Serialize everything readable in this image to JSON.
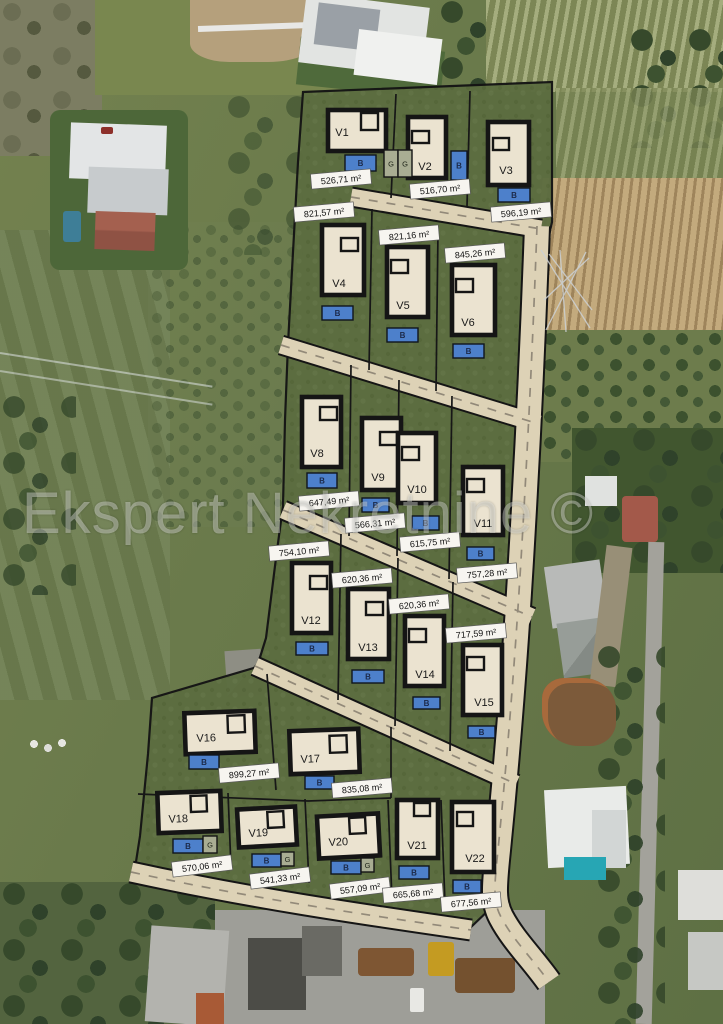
{
  "watermark": "Ekspert Nekretnine ©",
  "plan": {
    "unit": "m²",
    "badge_b_label": "B",
    "badge_g_label": "G",
    "colors": {
      "road": "#ddd2b6",
      "plan_grass": "#5c6d40",
      "house_fill": "#ebe3d0",
      "outline": "#151515",
      "badge_blue": "#4d80cb",
      "garage_fill": "#a9ad93",
      "area_label_bg": "#f7f5f0"
    },
    "extra_garages": [
      [
        384,
        150,
        14,
        27
      ],
      [
        398,
        150,
        14,
        27
      ]
    ],
    "villas": [
      {
        "id": "V1",
        "area": "526,71 m²",
        "house": [
          328,
          110,
          58,
          41
        ],
        "notch": [
          361,
          113,
          17,
          17
        ],
        "label": [
          342,
          132
        ],
        "badge": [
          345,
          155,
          31,
          16
        ],
        "area_label": [
          341,
          179,
          -5
        ]
      },
      {
        "id": "V2",
        "area": "516,70 m²",
        "house": [
          408,
          117,
          38,
          61
        ],
        "notch": [
          412,
          131,
          17,
          12
        ],
        "label": [
          425,
          166
        ],
        "badge": [
          451,
          151,
          16,
          29
        ],
        "area_label": [
          440,
          189,
          -5
        ]
      },
      {
        "id": "V3",
        "area": "596,19 m²",
        "house": [
          488,
          122,
          41,
          63
        ],
        "notch": [
          493,
          138,
          16,
          12
        ],
        "label": [
          506,
          170
        ],
        "badge": [
          498,
          188,
          32,
          14
        ],
        "area_label": [
          521,
          212,
          -5
        ]
      },
      {
        "id": "V4",
        "area": "821,57 m²",
        "house": [
          322,
          225,
          42,
          70
        ],
        "notch": [
          341,
          238,
          17,
          13
        ],
        "label": [
          339,
          283
        ],
        "badge": [
          322,
          306,
          31,
          14
        ],
        "area_label": [
          324,
          212,
          -5
        ]
      },
      {
        "id": "V5",
        "area": "821,16 m²",
        "house": [
          387,
          247,
          41,
          70
        ],
        "notch": [
          391,
          260,
          17,
          13
        ],
        "label": [
          403,
          305
        ],
        "badge": [
          387,
          328,
          31,
          14
        ],
        "area_label": [
          409,
          235,
          -5
        ]
      },
      {
        "id": "V6",
        "area": "845,26 m²",
        "house": [
          452,
          265,
          43,
          70
        ],
        "notch": [
          456,
          279,
          17,
          13
        ],
        "label": [
          468,
          322
        ],
        "badge": [
          453,
          344,
          31,
          14
        ],
        "area_label": [
          475,
          253,
          -5
        ]
      },
      {
        "id": "V8",
        "area": "647,49 m²",
        "house": [
          302,
          397,
          39,
          70
        ],
        "notch": [
          320,
          407,
          17,
          13
        ],
        "label": [
          317,
          453
        ],
        "badge": [
          307,
          473,
          30,
          15
        ],
        "area_label": [
          329,
          501,
          -5
        ]
      },
      {
        "id": "V9",
        "area": "566,31 m²",
        "house": [
          362,
          418,
          39,
          72
        ],
        "notch": [
          380,
          432,
          17,
          13
        ],
        "label": [
          378,
          477
        ],
        "badge": [
          362,
          498,
          27,
          14
        ],
        "area_label": [
          375,
          523,
          -5
        ]
      },
      {
        "id": "V10",
        "area": "615,75 m²",
        "house": [
          398,
          433,
          38,
          70
        ],
        "notch": [
          402,
          447,
          17,
          13
        ],
        "label": [
          417,
          489
        ],
        "badge": [
          412,
          516,
          27,
          14
        ],
        "area_label": [
          430,
          542,
          -5
        ]
      },
      {
        "id": "V11",
        "area": "757,28 m²",
        "house": [
          463,
          467,
          40,
          68
        ],
        "notch": [
          467,
          479,
          17,
          13
        ],
        "label": [
          483,
          523
        ],
        "badge": [
          467,
          547,
          27,
          13
        ],
        "area_label": [
          487,
          573,
          -5
        ]
      },
      {
        "id": "V12",
        "area": "754,10 m²",
        "house": [
          292,
          563,
          39,
          70
        ],
        "notch": [
          310,
          576,
          17,
          13
        ],
        "label": [
          311,
          620
        ],
        "badge": [
          296,
          642,
          32,
          13
        ],
        "area_label": [
          299,
          551,
          -5
        ]
      },
      {
        "id": "V13",
        "area": "620,36 m²",
        "house": [
          348,
          589,
          41,
          70
        ],
        "notch": [
          366,
          602,
          17,
          13
        ],
        "label": [
          368,
          647
        ],
        "badge": [
          352,
          670,
          32,
          13
        ],
        "area_label": [
          362,
          578,
          -5
        ]
      },
      {
        "id": "V14",
        "area": "620,36 m²",
        "house": [
          405,
          616,
          39,
          70
        ],
        "notch": [
          409,
          629,
          17,
          13
        ],
        "label": [
          425,
          674
        ],
        "badge": [
          413,
          697,
          27,
          12
        ],
        "area_label": [
          419,
          604,
          -5
        ]
      },
      {
        "id": "V15",
        "area": "717,59 m²",
        "house": [
          463,
          645,
          39,
          70
        ],
        "notch": [
          467,
          657,
          17,
          13
        ],
        "label": [
          484,
          702
        ],
        "badge": [
          468,
          726,
          27,
          12
        ],
        "area_label": [
          476,
          633,
          -5
        ]
      },
      {
        "id": "V16",
        "area": "899,27 m²",
        "house": [
          185,
          712,
          70,
          41,
          -2
        ],
        "notch": [
          228,
          716,
          17,
          17
        ],
        "label": [
          206,
          737
        ],
        "badge": [
          189,
          755,
          30,
          14
        ],
        "area_label": [
          249,
          773,
          -5
        ]
      },
      {
        "id": "V17",
        "area": "835,08 m²",
        "house": [
          290,
          730,
          69,
          43,
          -2
        ],
        "notch": [
          330,
          736,
          17,
          17
        ],
        "label": [
          310,
          758
        ],
        "badge": [
          305,
          776,
          29,
          13
        ],
        "area_label": [
          362,
          788,
          -5
        ]
      },
      {
        "id": "V18",
        "area": "570,06 m²",
        "house": [
          158,
          792,
          63,
          40,
          -2
        ],
        "notch": [
          191,
          796,
          16,
          16
        ],
        "label": [
          178,
          818
        ],
        "badge": [
          173,
          839,
          30,
          14
        ],
        "garage": [
          203,
          836,
          14,
          17
        ],
        "area_label": [
          202,
          866,
          -7
        ]
      },
      {
        "id": "V19",
        "area": "541,33 m²",
        "house": [
          238,
          808,
          58,
          38,
          -3
        ],
        "notch": [
          268,
          812,
          16,
          16
        ],
        "label": [
          258,
          832
        ],
        "badge": [
          252,
          854,
          29,
          13
        ],
        "garage": [
          281,
          852,
          13,
          14
        ],
        "area_label": [
          280,
          878,
          -7
        ]
      },
      {
        "id": "V20",
        "area": "557,09 m²",
        "house": [
          318,
          815,
          61,
          42,
          -3
        ],
        "notch": [
          350,
          818,
          16,
          16
        ],
        "label": [
          338,
          841
        ],
        "badge": [
          331,
          861,
          30,
          13
        ],
        "garage": [
          361,
          858,
          13,
          14
        ],
        "area_label": [
          360,
          888,
          -7
        ]
      },
      {
        "id": "V21",
        "area": "665,68 m²",
        "house": [
          397,
          800,
          41,
          58
        ],
        "notch": [
          414,
          803,
          16,
          13
        ],
        "label": [
          417,
          845
        ],
        "badge": [
          399,
          866,
          30,
          13
        ],
        "area_label": [
          413,
          893,
          -5
        ]
      },
      {
        "id": "V22",
        "area": "677,56 m²",
        "house": [
          452,
          802,
          42,
          70
        ],
        "notch": [
          457,
          812,
          16,
          14
        ],
        "label": [
          475,
          858
        ],
        "badge": [
          453,
          880,
          28,
          13
        ],
        "area_label": [
          471,
          902,
          -5
        ]
      }
    ]
  }
}
